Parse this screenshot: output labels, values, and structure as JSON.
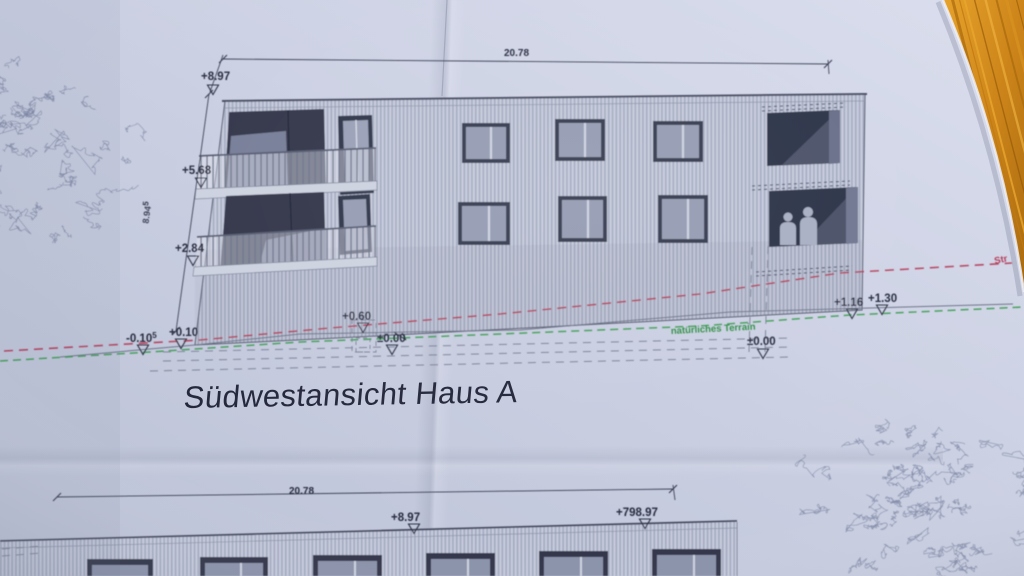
{
  "title": "Südwestansicht Haus A",
  "upper_elevation": {
    "width_dim": "20.78",
    "height_dim": {
      "value": "8.94",
      "sup": "5"
    },
    "levels": {
      "roof": "+8.97",
      "floor2": "+5.68",
      "floor1": "+2.84",
      "ground_left_low": {
        "value": "-0.10",
        "sup": "5"
      },
      "ground_left": "+0.10",
      "entrance_mid": "+0.60",
      "zero_mid": "±0.00",
      "zero_right": "±0.00",
      "street_right_a": "+1.16",
      "street_right_b": "+1.30"
    },
    "terrain_label": "natürliches Terrain",
    "street_label": "Str"
  },
  "lower_elevation": {
    "width_dim": "20.78",
    "levels": {
      "roof": "+8.97",
      "roof_absolute": "+798.97"
    }
  },
  "colors": {
    "paper": "#c9cee1",
    "wood_table": "#cf8a1e",
    "street_line_red": "#b33a56",
    "terrain_line_green": "#3d9b52",
    "ink": "#3a3f54",
    "facade": "#bdc3d5",
    "window_dark": "#2f344a"
  }
}
